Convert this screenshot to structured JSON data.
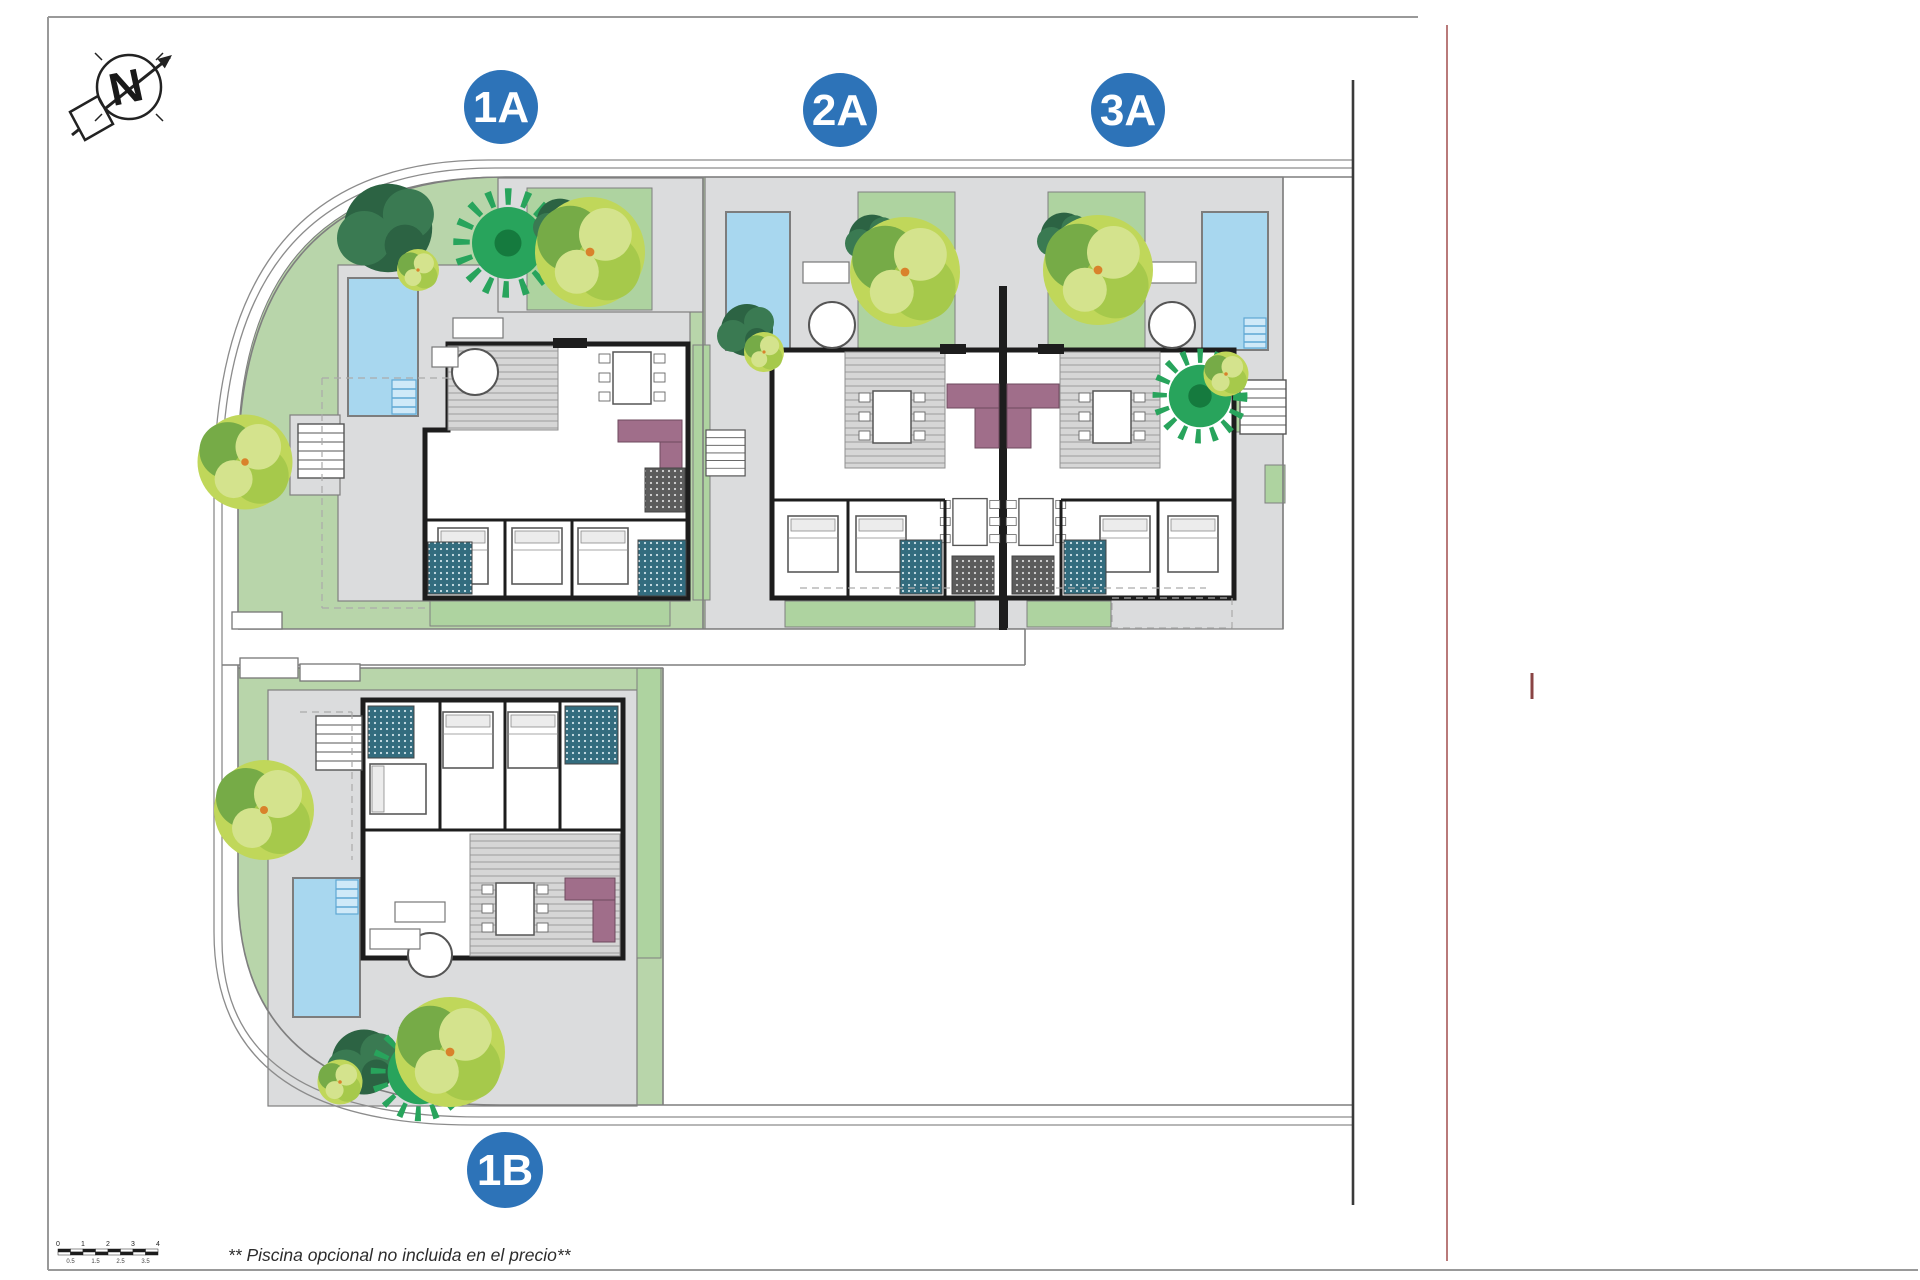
{
  "compass": {
    "label": "N"
  },
  "badges": [
    {
      "id": "1A",
      "label": "1A"
    },
    {
      "id": "2A",
      "label": "2A"
    },
    {
      "id": "3A",
      "label": "3A"
    },
    {
      "id": "1B",
      "label": "1B"
    }
  ],
  "note": "** Piscina opcional no incluida en el precio**",
  "scale_bar": {
    "top_labels": [
      "0",
      "1",
      "2",
      "3",
      "4"
    ],
    "bottom_labels": [
      "0.5",
      "1.5",
      "2.5",
      "3.5"
    ]
  },
  "colors": {
    "badge_blue": "#2d73b8",
    "garden_green": "#b8d5aa",
    "square_green": "#aed3a0",
    "terrace_gray": "#dbdcdd",
    "line_gray": "#7f7f7f",
    "road_line": "#8c8c8c",
    "wall_black": "#1d1d1d",
    "pool_blue": "#a8d7ef",
    "pool_edge": "#5fa8d4",
    "sofa_mauve": "#a06e8a",
    "bath_teal": "#336c7e",
    "kitchen_dark": "#5c5c5c",
    "tree_yellow": "#c0d75a",
    "tree_lime": "#a6c94b",
    "tree_light": "#d4e38d",
    "tree_mid": "#76ab47",
    "tree_dark": "#2c6343",
    "palm_green": "#28a45c",
    "orange_dot": "#d9822b",
    "frame_gray": "#999999",
    "red_line": "#b97a7a",
    "red_tick": "#8a4444"
  }
}
